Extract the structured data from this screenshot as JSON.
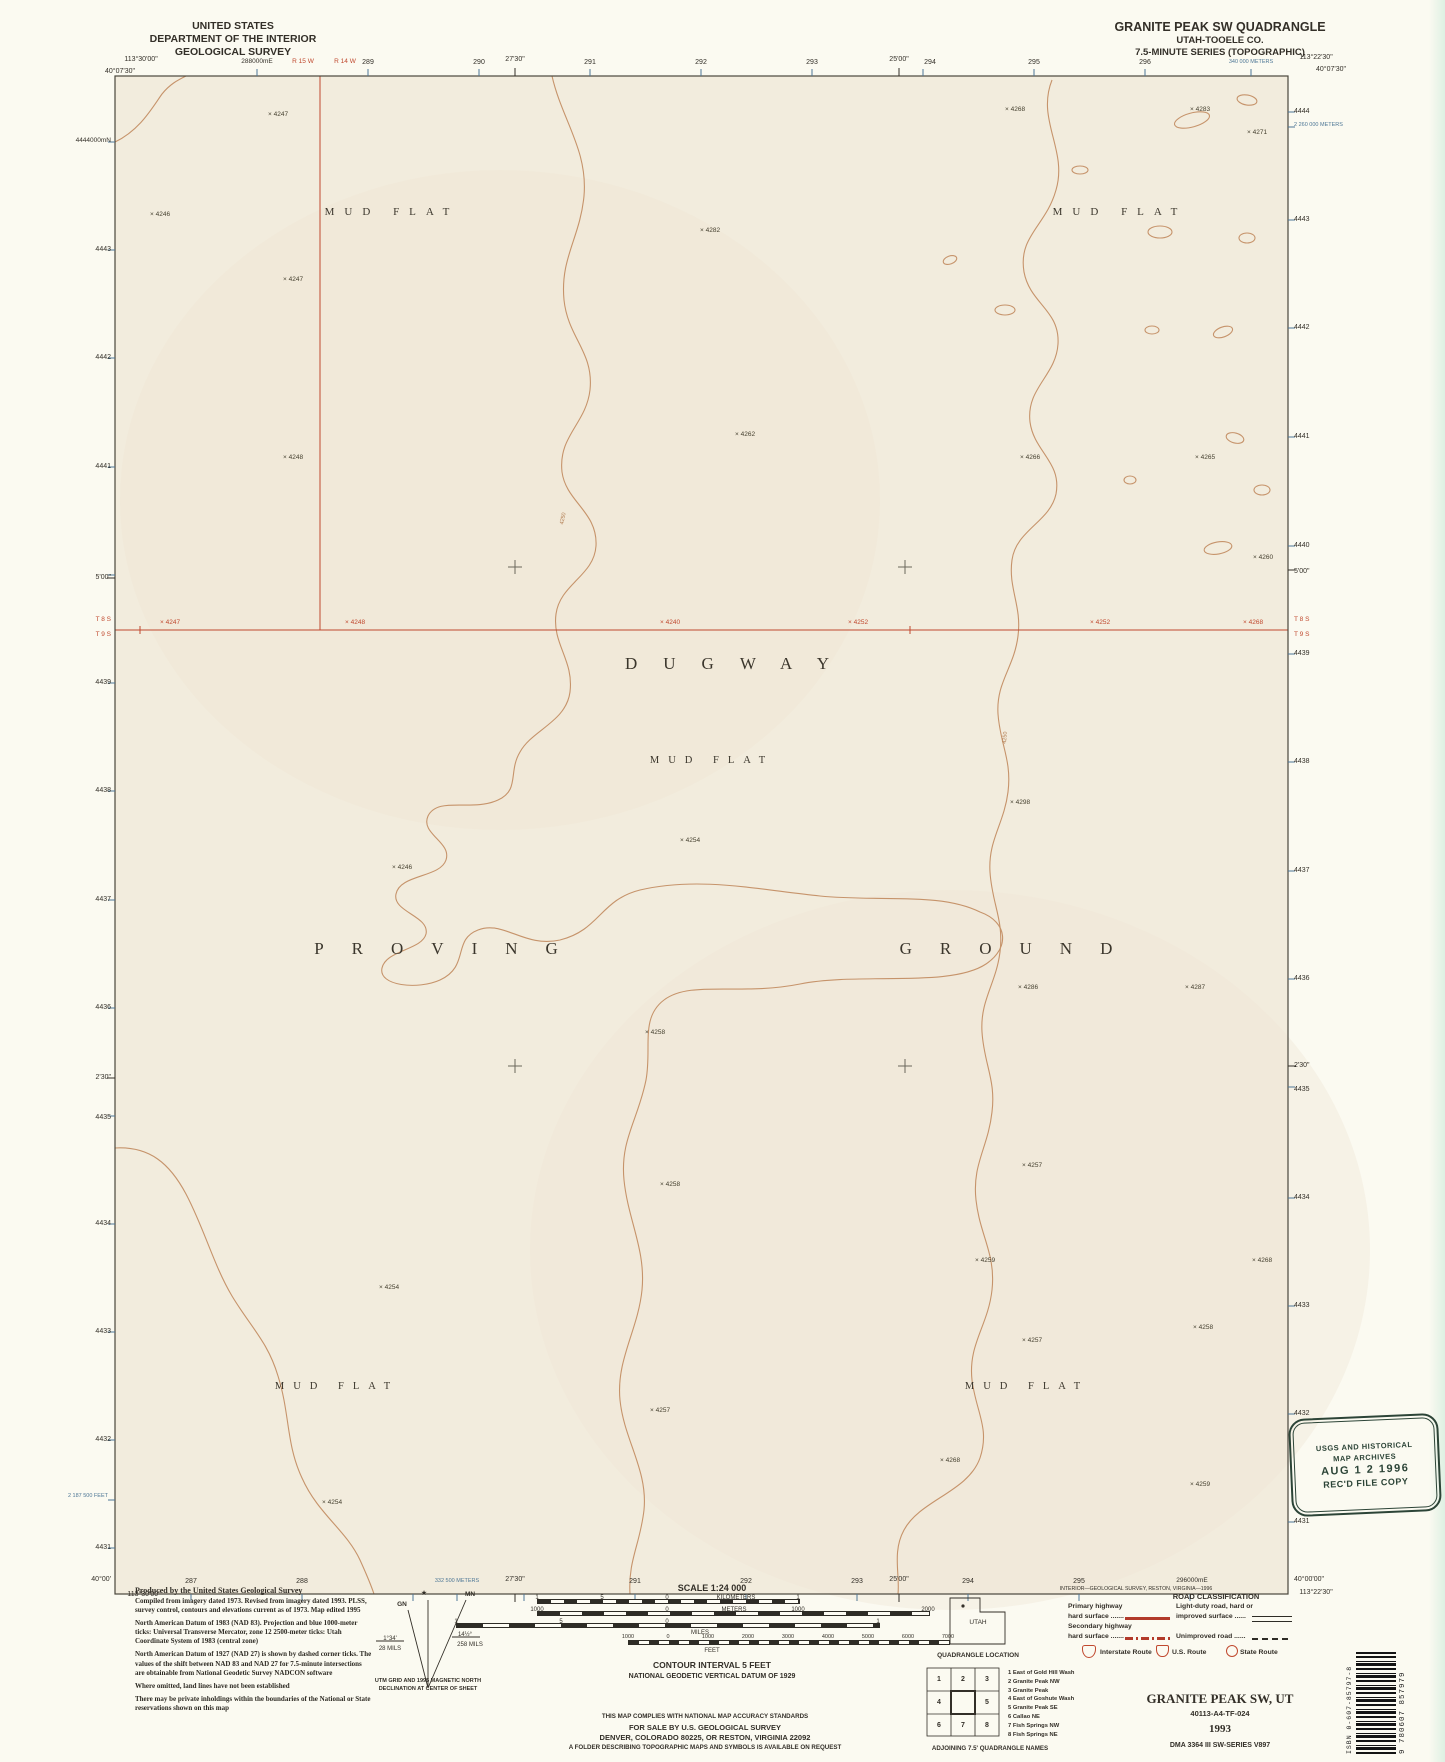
{
  "colors": {
    "paper": "#fbfaf1",
    "map_fill": "#f2ecdd",
    "contour": "#c18a5e",
    "red": "#c0492f",
    "blue": "#4e7796",
    "ink": "#332f28",
    "stamp": "#2c4437"
  },
  "header": {
    "left_lines": [
      "UNITED STATES",
      "DEPARTMENT OF THE INTERIOR",
      "GEOLOGICAL SURVEY"
    ],
    "right_lines": [
      "GRANITE PEAK SW QUADRANGLE",
      "UTAH-TOOELE CO.",
      "7.5-MINUTE SERIES (TOPOGRAPHIC)"
    ]
  },
  "margin_labels": [
    {
      "t": "113°30'00\"",
      "x": 141,
      "y": 56,
      "a": "c"
    },
    {
      "t": "40°07'30\"",
      "x": 120,
      "y": 68,
      "a": "c"
    },
    {
      "t": "288000mE",
      "x": 257,
      "y": 59,
      "a": "c",
      "s": 6.5
    },
    {
      "t": "R 15 W",
      "x": 303,
      "y": 59,
      "a": "c",
      "c": "red",
      "s": 6.5
    },
    {
      "t": "R 14 W",
      "x": 345,
      "y": 59,
      "a": "c",
      "c": "red",
      "s": 6.5
    },
    {
      "t": "289",
      "x": 368,
      "y": 59,
      "a": "c"
    },
    {
      "t": "290",
      "x": 479,
      "y": 59,
      "a": "c"
    },
    {
      "t": "27'30\"",
      "x": 515,
      "y": 56,
      "a": "c"
    },
    {
      "t": "291",
      "x": 590,
      "y": 59,
      "a": "c"
    },
    {
      "t": "292",
      "x": 701,
      "y": 59,
      "a": "c"
    },
    {
      "t": "293",
      "x": 812,
      "y": 59,
      "a": "c"
    },
    {
      "t": "25'00\"",
      "x": 899,
      "y": 56,
      "a": "c"
    },
    {
      "t": "294",
      "x": 930,
      "y": 59,
      "a": "c"
    },
    {
      "t": "295",
      "x": 1034,
      "y": 59,
      "a": "c"
    },
    {
      "t": "296",
      "x": 1145,
      "y": 59,
      "a": "c"
    },
    {
      "t": "340 000 METERS",
      "x": 1251,
      "y": 60,
      "a": "c",
      "c": "blue",
      "s": 5.5
    },
    {
      "t": "113°22'30\"",
      "x": 1316,
      "y": 54,
      "a": "c"
    },
    {
      "t": "40°07'30\"",
      "x": 1331,
      "y": 66,
      "a": "c"
    },
    {
      "t": "4444000mN",
      "x": 111,
      "y": 138,
      "a": "r",
      "s": 6.5
    },
    {
      "t": "4443",
      "x": 111,
      "y": 246,
      "a": "r"
    },
    {
      "t": "4442",
      "x": 111,
      "y": 354,
      "a": "r"
    },
    {
      "t": "4441",
      "x": 111,
      "y": 463,
      "a": "r"
    },
    {
      "t": "5'00\"",
      "x": 111,
      "y": 574,
      "a": "r"
    },
    {
      "t": "T 8 S",
      "x": 111,
      "y": 617,
      "a": "r",
      "c": "red",
      "s": 6.5
    },
    {
      "t": "T 9 S",
      "x": 111,
      "y": 632,
      "a": "r",
      "c": "red",
      "s": 6.5
    },
    {
      "t": "4439",
      "x": 111,
      "y": 679,
      "a": "r"
    },
    {
      "t": "4438",
      "x": 111,
      "y": 787,
      "a": "r"
    },
    {
      "t": "4437",
      "x": 111,
      "y": 896,
      "a": "r"
    },
    {
      "t": "4436",
      "x": 111,
      "y": 1004,
      "a": "r"
    },
    {
      "t": "2'30\"",
      "x": 111,
      "y": 1074,
      "a": "r"
    },
    {
      "t": "4435",
      "x": 111,
      "y": 1114,
      "a": "r"
    },
    {
      "t": "4434",
      "x": 111,
      "y": 1220,
      "a": "r"
    },
    {
      "t": "4433",
      "x": 111,
      "y": 1328,
      "a": "r"
    },
    {
      "t": "4432",
      "x": 111,
      "y": 1436,
      "a": "r"
    },
    {
      "t": "2 187 500 FEET",
      "x": 108,
      "y": 1494,
      "a": "r",
      "c": "blue",
      "s": 5.5
    },
    {
      "t": "4431",
      "x": 111,
      "y": 1544,
      "a": "r"
    },
    {
      "t": "40°00'",
      "x": 111,
      "y": 1576,
      "a": "r"
    },
    {
      "t": "4444",
      "x": 1294,
      "y": 108,
      "a": "l"
    },
    {
      "t": "2 260 000 METERS",
      "x": 1294,
      "y": 123,
      "a": "l",
      "c": "blue",
      "s": 5.5
    },
    {
      "t": "4443",
      "x": 1294,
      "y": 216,
      "a": "l"
    },
    {
      "t": "4442",
      "x": 1294,
      "y": 324,
      "a": "l"
    },
    {
      "t": "4441",
      "x": 1294,
      "y": 433,
      "a": "l"
    },
    {
      "t": "4440",
      "x": 1294,
      "y": 542,
      "a": "l"
    },
    {
      "t": "5'00\"",
      "x": 1294,
      "y": 568,
      "a": "l"
    },
    {
      "t": "T 8 S",
      "x": 1294,
      "y": 617,
      "a": "l",
      "c": "red",
      "s": 6.5
    },
    {
      "t": "T 9 S",
      "x": 1294,
      "y": 632,
      "a": "l",
      "c": "red",
      "s": 6.5
    },
    {
      "t": "4439",
      "x": 1294,
      "y": 650,
      "a": "l"
    },
    {
      "t": "4438",
      "x": 1294,
      "y": 758,
      "a": "l"
    },
    {
      "t": "4437",
      "x": 1294,
      "y": 867,
      "a": "l"
    },
    {
      "t": "4436",
      "x": 1294,
      "y": 975,
      "a": "l"
    },
    {
      "t": "2'30\"",
      "x": 1294,
      "y": 1062,
      "a": "l"
    },
    {
      "t": "4435",
      "x": 1294,
      "y": 1086,
      "a": "l"
    },
    {
      "t": "4434",
      "x": 1294,
      "y": 1194,
      "a": "l"
    },
    {
      "t": "4433",
      "x": 1294,
      "y": 1302,
      "a": "l"
    },
    {
      "t": "4432",
      "x": 1294,
      "y": 1410,
      "a": "l"
    },
    {
      "t": "4431",
      "x": 1294,
      "y": 1518,
      "a": "l"
    },
    {
      "t": "40°00'00\"",
      "x": 1294,
      "y": 1576,
      "a": "l"
    },
    {
      "t": "287",
      "x": 191,
      "y": 1578,
      "a": "c"
    },
    {
      "t": "288",
      "x": 302,
      "y": 1578,
      "a": "c"
    },
    {
      "t": "332 500 METERS",
      "x": 457,
      "y": 1579,
      "a": "c",
      "c": "blue",
      "s": 5.5
    },
    {
      "t": "27'30\"",
      "x": 515,
      "y": 1576,
      "a": "c"
    },
    {
      "t": "291",
      "x": 635,
      "y": 1578,
      "a": "c"
    },
    {
      "t": "292",
      "x": 746,
      "y": 1578,
      "a": "c"
    },
    {
      "t": "293",
      "x": 857,
      "y": 1578,
      "a": "c"
    },
    {
      "t": "25'00\"",
      "x": 899,
      "y": 1576,
      "a": "c"
    },
    {
      "t": "294",
      "x": 968,
      "y": 1578,
      "a": "c"
    },
    {
      "t": "295",
      "x": 1079,
      "y": 1578,
      "a": "c"
    },
    {
      "t": "296000mE",
      "x": 1192,
      "y": 1578,
      "a": "c",
      "s": 6.5
    },
    {
      "t": "113°30'00\"",
      "x": 144,
      "y": 1591,
      "a": "c"
    },
    {
      "t": "113°22'30\"",
      "x": 1316,
      "y": 1589,
      "a": "c"
    },
    {
      "t": "INTERIOR—GEOLOGICAL SURVEY, RESTON, VIRGINIA—1996",
      "x": 1136,
      "y": 1587,
      "a": "c",
      "s": 5.2
    }
  ],
  "legend_labels": [
    {
      "t": "SCALE 1:24 000",
      "x": 712,
      "y": 1584,
      "a": "c",
      "s": 9,
      "b": 1
    },
    {
      "t": "1",
      "x": 537,
      "y": 1595,
      "a": "c",
      "s": 6
    },
    {
      "t": "5",
      "x": 602,
      "y": 1595,
      "a": "c",
      "s": 6
    },
    {
      "t": "0",
      "x": 667,
      "y": 1595,
      "a": "c",
      "s": 6
    },
    {
      "t": "KILOMETERS",
      "x": 736,
      "y": 1595,
      "a": "c",
      "s": 6
    },
    {
      "t": "1",
      "x": 798,
      "y": 1595,
      "a": "c",
      "s": 6
    },
    {
      "t": "1000",
      "x": 537,
      "y": 1607,
      "a": "c",
      "s": 6
    },
    {
      "t": "0",
      "x": 667,
      "y": 1607,
      "a": "c",
      "s": 6
    },
    {
      "t": "METERS",
      "x": 734,
      "y": 1607,
      "a": "c",
      "s": 6
    },
    {
      "t": "1000",
      "x": 798,
      "y": 1607,
      "a": "c",
      "s": 6
    },
    {
      "t": "2000",
      "x": 928,
      "y": 1607,
      "a": "c",
      "s": 6
    },
    {
      "t": "1",
      "x": 456,
      "y": 1619,
      "a": "c",
      "s": 6
    },
    {
      "t": "5",
      "x": 561,
      "y": 1619,
      "a": "c",
      "s": 6
    },
    {
      "t": "0",
      "x": 667,
      "y": 1619,
      "a": "c",
      "s": 6
    },
    {
      "t": "1",
      "x": 878,
      "y": 1619,
      "a": "c",
      "s": 6
    },
    {
      "t": "MILES",
      "x": 700,
      "y": 1630,
      "a": "c",
      "s": 6
    },
    {
      "t": "1000",
      "x": 628,
      "y": 1635,
      "a": "c",
      "s": 5.5
    },
    {
      "t": "0",
      "x": 668,
      "y": 1635,
      "a": "c",
      "s": 5.5
    },
    {
      "t": "1000",
      "x": 708,
      "y": 1635,
      "a": "c",
      "s": 5.5
    },
    {
      "t": "2000",
      "x": 748,
      "y": 1635,
      "a": "c",
      "s": 5.5
    },
    {
      "t": "3000",
      "x": 788,
      "y": 1635,
      "a": "c",
      "s": 5.5
    },
    {
      "t": "4000",
      "x": 828,
      "y": 1635,
      "a": "c",
      "s": 5.5
    },
    {
      "t": "5000",
      "x": 868,
      "y": 1635,
      "a": "c",
      "s": 5.5
    },
    {
      "t": "6000",
      "x": 908,
      "y": 1635,
      "a": "c",
      "s": 5.5
    },
    {
      "t": "7000",
      "x": 948,
      "y": 1635,
      "a": "c",
      "s": 5.5
    },
    {
      "t": "FEET",
      "x": 712,
      "y": 1648,
      "a": "c",
      "s": 6
    },
    {
      "t": "CONTOUR INTERVAL 5 FEET",
      "x": 712,
      "y": 1661,
      "a": "c",
      "s": 8.5,
      "b": 1
    },
    {
      "t": "NATIONAL GEODETIC VERTICAL DATUM OF 1929",
      "x": 712,
      "y": 1673,
      "a": "c",
      "s": 7,
      "b": 1
    },
    {
      "t": "THIS MAP COMPLIES WITH NATIONAL MAP ACCURACY STANDARDS",
      "x": 705,
      "y": 1714,
      "a": "c",
      "s": 6.2,
      "b": 1
    },
    {
      "t": "FOR SALE BY U.S. GEOLOGICAL SURVEY",
      "x": 705,
      "y": 1724,
      "a": "c",
      "s": 7.5,
      "b": 1
    },
    {
      "t": "DENVER, COLORADO 80225, OR RESTON, VIRGINIA 22092",
      "x": 705,
      "y": 1734,
      "a": "c",
      "s": 7.5,
      "b": 1
    },
    {
      "t": "A FOLDER DESCRIBING TOPOGRAPHIC MAPS AND SYMBOLS IS AVAILABLE ON REQUEST",
      "x": 705,
      "y": 1745,
      "a": "c",
      "s": 6.2,
      "b": 1
    },
    {
      "t": "★",
      "x": 424,
      "y": 1590,
      "a": "c",
      "s": 7
    },
    {
      "t": "GN",
      "x": 402,
      "y": 1602,
      "a": "c",
      "s": 6.5,
      "b": 1
    },
    {
      "t": "MN",
      "x": 470,
      "y": 1592,
      "a": "c",
      "s": 6.5,
      "b": 1
    },
    {
      "t": "1°34'",
      "x": 390,
      "y": 1636,
      "a": "c",
      "s": 6
    },
    {
      "t": "28 MILS",
      "x": 390,
      "y": 1646,
      "a": "c",
      "s": 6
    },
    {
      "t": "14½°",
      "x": 465,
      "y": 1632,
      "a": "c",
      "s": 6
    },
    {
      "t": "258 MILS",
      "x": 470,
      "y": 1642,
      "a": "c",
      "s": 6
    },
    {
      "t": "UTM GRID AND 1995 MAGNETIC NORTH",
      "x": 428,
      "y": 1679,
      "a": "c",
      "s": 5.5,
      "b": 1
    },
    {
      "t": "DECLINATION AT CENTER OF SHEET",
      "x": 428,
      "y": 1687,
      "a": "c",
      "s": 5.5,
      "b": 1
    },
    {
      "t": "UTAH",
      "x": 978,
      "y": 1620,
      "a": "c",
      "s": 6.5
    },
    {
      "t": "QUADRANGLE LOCATION",
      "x": 978,
      "y": 1653,
      "a": "c",
      "s": 6.5,
      "b": 1
    },
    {
      "t": "ROAD CLASSIFICATION",
      "x": 1216,
      "y": 1593,
      "a": "c",
      "s": 7.5,
      "b": 1
    },
    {
      "t": "Primary highway",
      "x": 1068,
      "y": 1604,
      "a": "l",
      "s": 6.8,
      "b": 1
    },
    {
      "t": "hard surface .......",
      "x": 1068,
      "y": 1614,
      "a": "l",
      "s": 6.8,
      "b": 1
    },
    {
      "t": "Secondary highway",
      "x": 1068,
      "y": 1624,
      "a": "l",
      "s": 6.8,
      "b": 1
    },
    {
      "t": "hard surface .......",
      "x": 1068,
      "y": 1634,
      "a": "l",
      "s": 6.8,
      "b": 1
    },
    {
      "t": "Light-duty road, hard or",
      "x": 1176,
      "y": 1604,
      "a": "l",
      "s": 6.8,
      "b": 1
    },
    {
      "t": "improved surface ......",
      "x": 1176,
      "y": 1614,
      "a": "l",
      "s": 6.8,
      "b": 1
    },
    {
      "t": "Unimproved road ......",
      "x": 1176,
      "y": 1634,
      "a": "l",
      "s": 6.8,
      "b": 1
    },
    {
      "t": "Interstate Route",
      "x": 1100,
      "y": 1650,
      "a": "l",
      "s": 6.8,
      "b": 1
    },
    {
      "t": "U.S. Route",
      "x": 1172,
      "y": 1650,
      "a": "l",
      "s": 6.8,
      "b": 1
    },
    {
      "t": "State Route",
      "x": 1240,
      "y": 1650,
      "a": "l",
      "s": 6.8,
      "b": 1
    },
    {
      "t": "GRANITE PEAK SW, UT",
      "x": 1220,
      "y": 1692,
      "a": "c",
      "s": 13,
      "b": 1,
      "f": 1
    },
    {
      "t": "40113-A4-TF-024",
      "x": 1220,
      "y": 1710,
      "a": "c",
      "s": 7.5,
      "b": 1
    },
    {
      "t": "1993",
      "x": 1220,
      "y": 1724,
      "a": "c",
      "s": 11,
      "b": 1,
      "f": 1
    },
    {
      "t": "DMA 3364 III SW-SERIES V897",
      "x": 1220,
      "y": 1742,
      "a": "c",
      "s": 7,
      "b": 1
    },
    {
      "t": "ADJOINING 7.5' QUADRANGLE NAMES",
      "x": 990,
      "y": 1746,
      "a": "c",
      "s": 6.2,
      "b": 1
    }
  ],
  "map": {
    "place_labels": [
      {
        "t": "MUD FLAT",
        "x": 392,
        "y": 207,
        "s": 11,
        "ls": 10
      },
      {
        "t": "MUD FLAT",
        "x": 1120,
        "y": 207,
        "s": 11,
        "ls": 10
      },
      {
        "t": "DUGWAY",
        "x": 740,
        "y": 655,
        "s": 17,
        "ls": 26
      },
      {
        "t": "MUD FLAT",
        "x": 712,
        "y": 756,
        "s": 10.5,
        "ls": 9
      },
      {
        "t": "PROVING",
        "x": 450,
        "y": 940,
        "s": 17,
        "ls": 28
      },
      {
        "t": "GROUND",
        "x": 1020,
        "y": 940,
        "s": 17,
        "ls": 28
      },
      {
        "t": "MUD FLAT",
        "x": 337,
        "y": 1382,
        "s": 10.5,
        "ls": 9
      },
      {
        "t": "MUD FLAT",
        "x": 1027,
        "y": 1382,
        "s": 10.5,
        "ls": 9
      }
    ],
    "spots": [
      {
        "x": 268,
        "y": 112,
        "v": "4247"
      },
      {
        "x": 150,
        "y": 212,
        "v": "4246"
      },
      {
        "x": 283,
        "y": 277,
        "v": "4247"
      },
      {
        "x": 700,
        "y": 228,
        "v": "4282"
      },
      {
        "x": 1005,
        "y": 107,
        "v": "4268"
      },
      {
        "x": 1190,
        "y": 107,
        "v": "4283"
      },
      {
        "x": 1247,
        "y": 130,
        "v": "4271"
      },
      {
        "x": 283,
        "y": 455,
        "v": "4248"
      },
      {
        "x": 735,
        "y": 432,
        "v": "4262"
      },
      {
        "x": 1020,
        "y": 455,
        "v": "4266"
      },
      {
        "x": 1195,
        "y": 455,
        "v": "4265"
      },
      {
        "x": 1253,
        "y": 555,
        "v": "4260"
      },
      {
        "x": 1010,
        "y": 800,
        "v": "4298"
      },
      {
        "x": 680,
        "y": 838,
        "v": "4254"
      },
      {
        "x": 392,
        "y": 865,
        "v": "4246"
      },
      {
        "x": 1018,
        "y": 985,
        "v": "4286"
      },
      {
        "x": 1185,
        "y": 985,
        "v": "4287"
      },
      {
        "x": 645,
        "y": 1030,
        "v": "4258"
      },
      {
        "x": 1022,
        "y": 1163,
        "v": "4257"
      },
      {
        "x": 660,
        "y": 1182,
        "v": "4258"
      },
      {
        "x": 975,
        "y": 1258,
        "v": "4259"
      },
      {
        "x": 1252,
        "y": 1258,
        "v": "4268"
      },
      {
        "x": 379,
        "y": 1285,
        "v": "4254"
      },
      {
        "x": 1193,
        "y": 1325,
        "v": "4258"
      },
      {
        "x": 1022,
        "y": 1338,
        "v": "4257"
      },
      {
        "x": 650,
        "y": 1408,
        "v": "4257"
      },
      {
        "x": 940,
        "y": 1458,
        "v": "4268"
      },
      {
        "x": 322,
        "y": 1500,
        "v": "4254"
      },
      {
        "x": 1190,
        "y": 1482,
        "v": "4259"
      }
    ],
    "red_spots": [
      {
        "x": 160,
        "y": 620,
        "v": "4247"
      },
      {
        "x": 345,
        "y": 620,
        "v": "4248"
      },
      {
        "x": 660,
        "y": 620,
        "v": "4240"
      },
      {
        "x": 848,
        "y": 620,
        "v": "4252"
      },
      {
        "x": 1090,
        "y": 620,
        "v": "4252"
      },
      {
        "x": 1243,
        "y": 620,
        "v": "4268"
      }
    ],
    "contour_labels": [
      {
        "v": "4250",
        "x": 558,
        "y": 516,
        "rot": -78
      },
      {
        "v": "4250",
        "x": 1000,
        "y": 735,
        "rot": -85
      }
    ]
  },
  "credits": {
    "produced": "Produced by the United States Geological Survey",
    "paragraphs": [
      "Compiled from imagery dated 1973.  Revised from imagery dated 1993.  PLSS, survey control, contours and elevations current as of 1973.  Map edited 1995",
      "North American Datum of 1983 (NAD 83).  Projection and blue 1000-meter ticks: Universal Transverse Mercator, zone 12 2500-meter ticks: Utah Coordinate System of 1983 (central zone)",
      "North American Datum of 1927 (NAD 27) is shown by dashed corner ticks.  The values of the shift between NAD 83 and NAD 27 for 7.5-minute intersections are obtainable from National Geodetic Survey NADCON software",
      "Where omitted, land lines have not been established",
      "There may be private inholdings within the boundaries of the National or State reservations shown on this map"
    ]
  },
  "adjoining": {
    "cells": [
      [
        "1",
        "2",
        "3"
      ],
      [
        "4",
        "",
        "5"
      ],
      [
        "6",
        "7",
        "8"
      ]
    ],
    "names": [
      "1 East of Gold Hill Wash",
      "2 Granite Peak NW",
      "3 Granite Peak",
      "4 East of Goshute Wash",
      "5 Granite Peak SE",
      "6 Callao NE",
      "7 Fish Springs NW",
      "8 Fish Springs NE"
    ]
  },
  "stamp": {
    "l1": "USGS AND HISTORICAL",
    "l2": "MAP ARCHIVES",
    "l3": "AUG 1 2 1996",
    "l4": "REC'D FILE COPY"
  },
  "barcode": {
    "isbn": "ISBN 0-607-85797-8",
    "number": "9 780607 857979"
  }
}
